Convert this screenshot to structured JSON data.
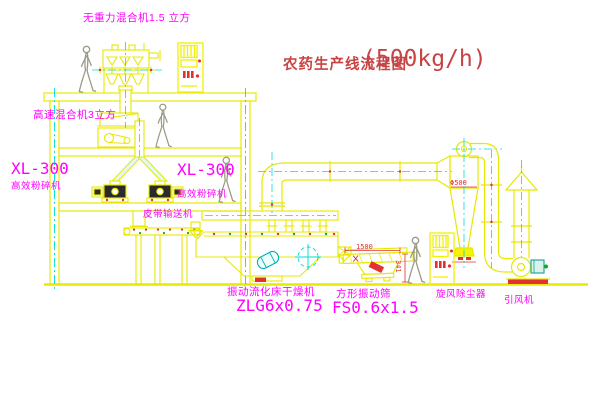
{
  "title": {
    "name": "农药生产线流程图",
    "capacity": "(500kg/h)"
  },
  "equipment_labels": {
    "gravity_mixer": "无重力混合机1.5 立方",
    "high_speed_mixer": "高速混合机3立方",
    "pulverizer_left": {
      "model": "XL-300",
      "name": "高效粉碎机"
    },
    "pulverizer_right": {
      "model": "XL-300",
      "name": "高效粉碎机"
    },
    "belt_conveyor": "皮带输送机",
    "fluid_bed_dryer": {
      "name": "振动流化床干燥机",
      "model": "ZLG6x0.75"
    },
    "vibrating_screen": {
      "name": "方形振动筛",
      "model": "FS0.6x1.5"
    },
    "cyclone_dust_collector": "旋风除尘器",
    "induced_draft_fan": "引风机"
  },
  "dimension_labels": {
    "screen_length": "1500",
    "screen_height": "341",
    "cyclone_diameter": "Φ500"
  },
  "colors": {
    "line_yellow": "#E8E800",
    "centerline_cyan": "#00DCDC",
    "label_magenta": "#FF00FF",
    "annotation_red": "#D24040",
    "background": "#FFFFFF"
  }
}
